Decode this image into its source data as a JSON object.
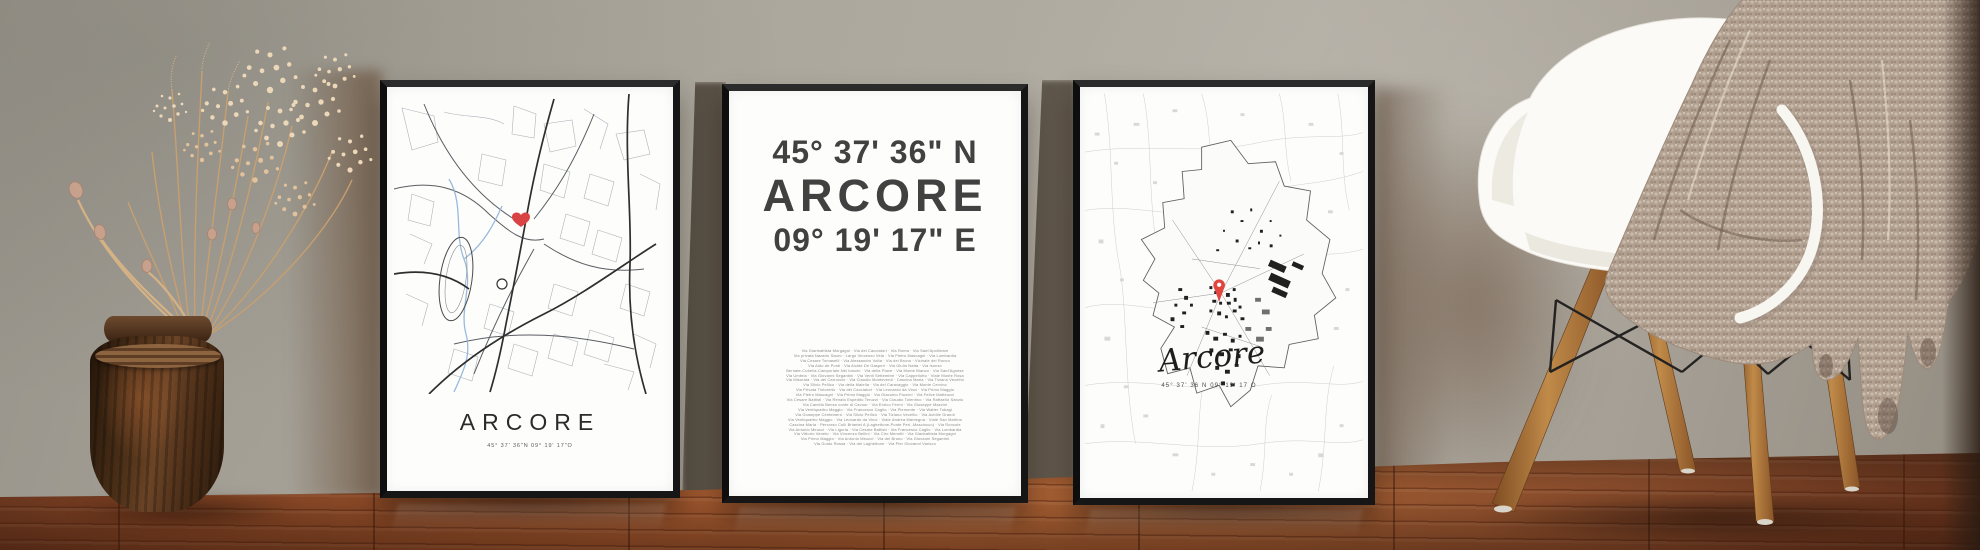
{
  "accent_colors": {
    "marker_red": "#e0463f",
    "frame_black": "#161616",
    "wall_gray": "#aaa69c",
    "floor_wood": "#96512b",
    "blanket_taupe": "#b2a091",
    "chair_white": "#fbfaf6",
    "vase_brown": "#4c3018"
  },
  "posters": {
    "left_map": {
      "title": "ARCORE",
      "coordinates": "45° 37' 36\"N 09° 19' 17\"O",
      "marker": "heart-marker"
    },
    "center_coordinates": {
      "latitude": "45° 37' 36\" N",
      "city": "ARCORE",
      "longitude": "09° 19' 17\" E",
      "street_lines": [
        "Via Gianbattista Morgagni · Via dei Cacciatori · Via Roma · Via Sant'Apollinare",
        "Via privata Nazario Sauro · Largo Vincenzo Vela · Via Pietro Mascagni · Via Lombardia",
        "Via Cesare Tomaselli · Via Alessandro Volta · Via del Bruno · Vicinale del Ronco",
        "Via Aldo de Ponti · Via Alcide De Gasperi · Via Giulio Natta · Via Isonzo",
        "Bernate-Cubella-Camporiale-Nei boschi · Via della Piave · Via Monte Bianco · Via Sant'Agnese",
        "Via Umbria · Via Giovanni Segantini · Via Venti Settembre · Via Cappellotto · Viale Monte Rosa",
        "Via Misurata · Via del Carroccio · Via Claudio Monteverdi · Cascina Maria · Via Tiziano Vecellio",
        "Via Silvio Pellico · Via della Maiella · Via del Caravaggio · Via Monte Cervino",
        "Via Privata Tintoretto · Via dei Cacciatori · Via Leonardo da Vinci · Via Primo Maggio",
        "Via Pietro Mascagni · Via Primo Maggio · Via Giacomo Puccini · Via Felice Matteucci",
        "Via Cesare Battisti · Via Renato Espedito Teruzzi · Via Claudio Tolentino · Via Raffaello Sanzio",
        "Via Camillo Benso conte di Cavour · Via Enrico Fermi · Via Giuseppe Mazzini",
        "Via Ventiquattro Maggio · Via Francesco Caglio · Via Piemonte · Via Walter Tobagi",
        "Via Giuseppe Centemero · Via Silvio Pellico · Via Tiziano Vecellio · Via Achille Grandi",
        "Via Ventiquattro Maggio · Via Leonardo da Vinci · Viale Andrea Mantegna · Viale San Martino",
        "Cascina Maria · Percorso Colli Briantei A (Laghettone-Ponte Peri.-Masciocco) · Via Roncole",
        "Via Antonio Meucci · Via Liguria · Via Cesare Battisti · Via Francesco Caglio · Via Lombardia",
        "Via Vittorio Veneto · Via Vincenzo Bellini · Via Ciro Menotti · Via Gianbattista Morgagni",
        "Via Primo Maggio · Via Antonio Meucci · Via del Bruno · Via Giovanni Segantini",
        "Via Guido Rossa · Via del Laghettone · Via Pier Giovanni Varisco"
      ]
    },
    "right_map": {
      "title": "Arcore",
      "coordinates": "45° 37' 36 N 09° 19' 17 O",
      "marker": "pin-marker"
    }
  }
}
